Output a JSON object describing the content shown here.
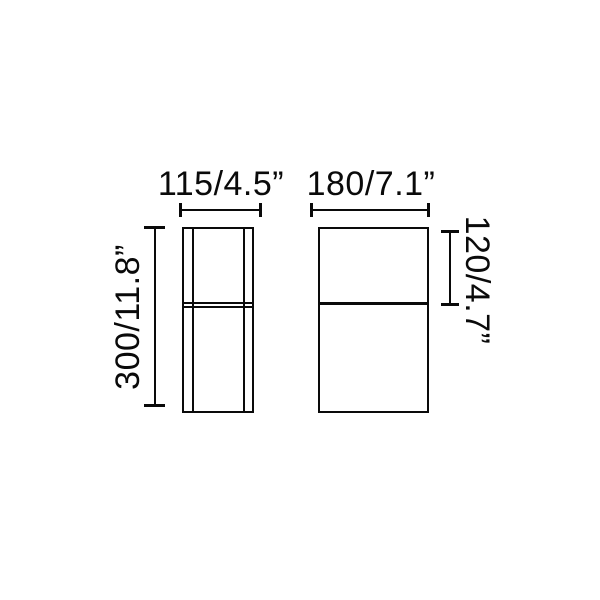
{
  "colors": {
    "background": "#ffffff",
    "line": "#0a0a0a"
  },
  "dimensions": {
    "side_view_width": "115/4.5”",
    "front_view_width": "180/7.1”",
    "overall_height": "300/11.8”",
    "upper_section_height": "120/4.7”"
  }
}
